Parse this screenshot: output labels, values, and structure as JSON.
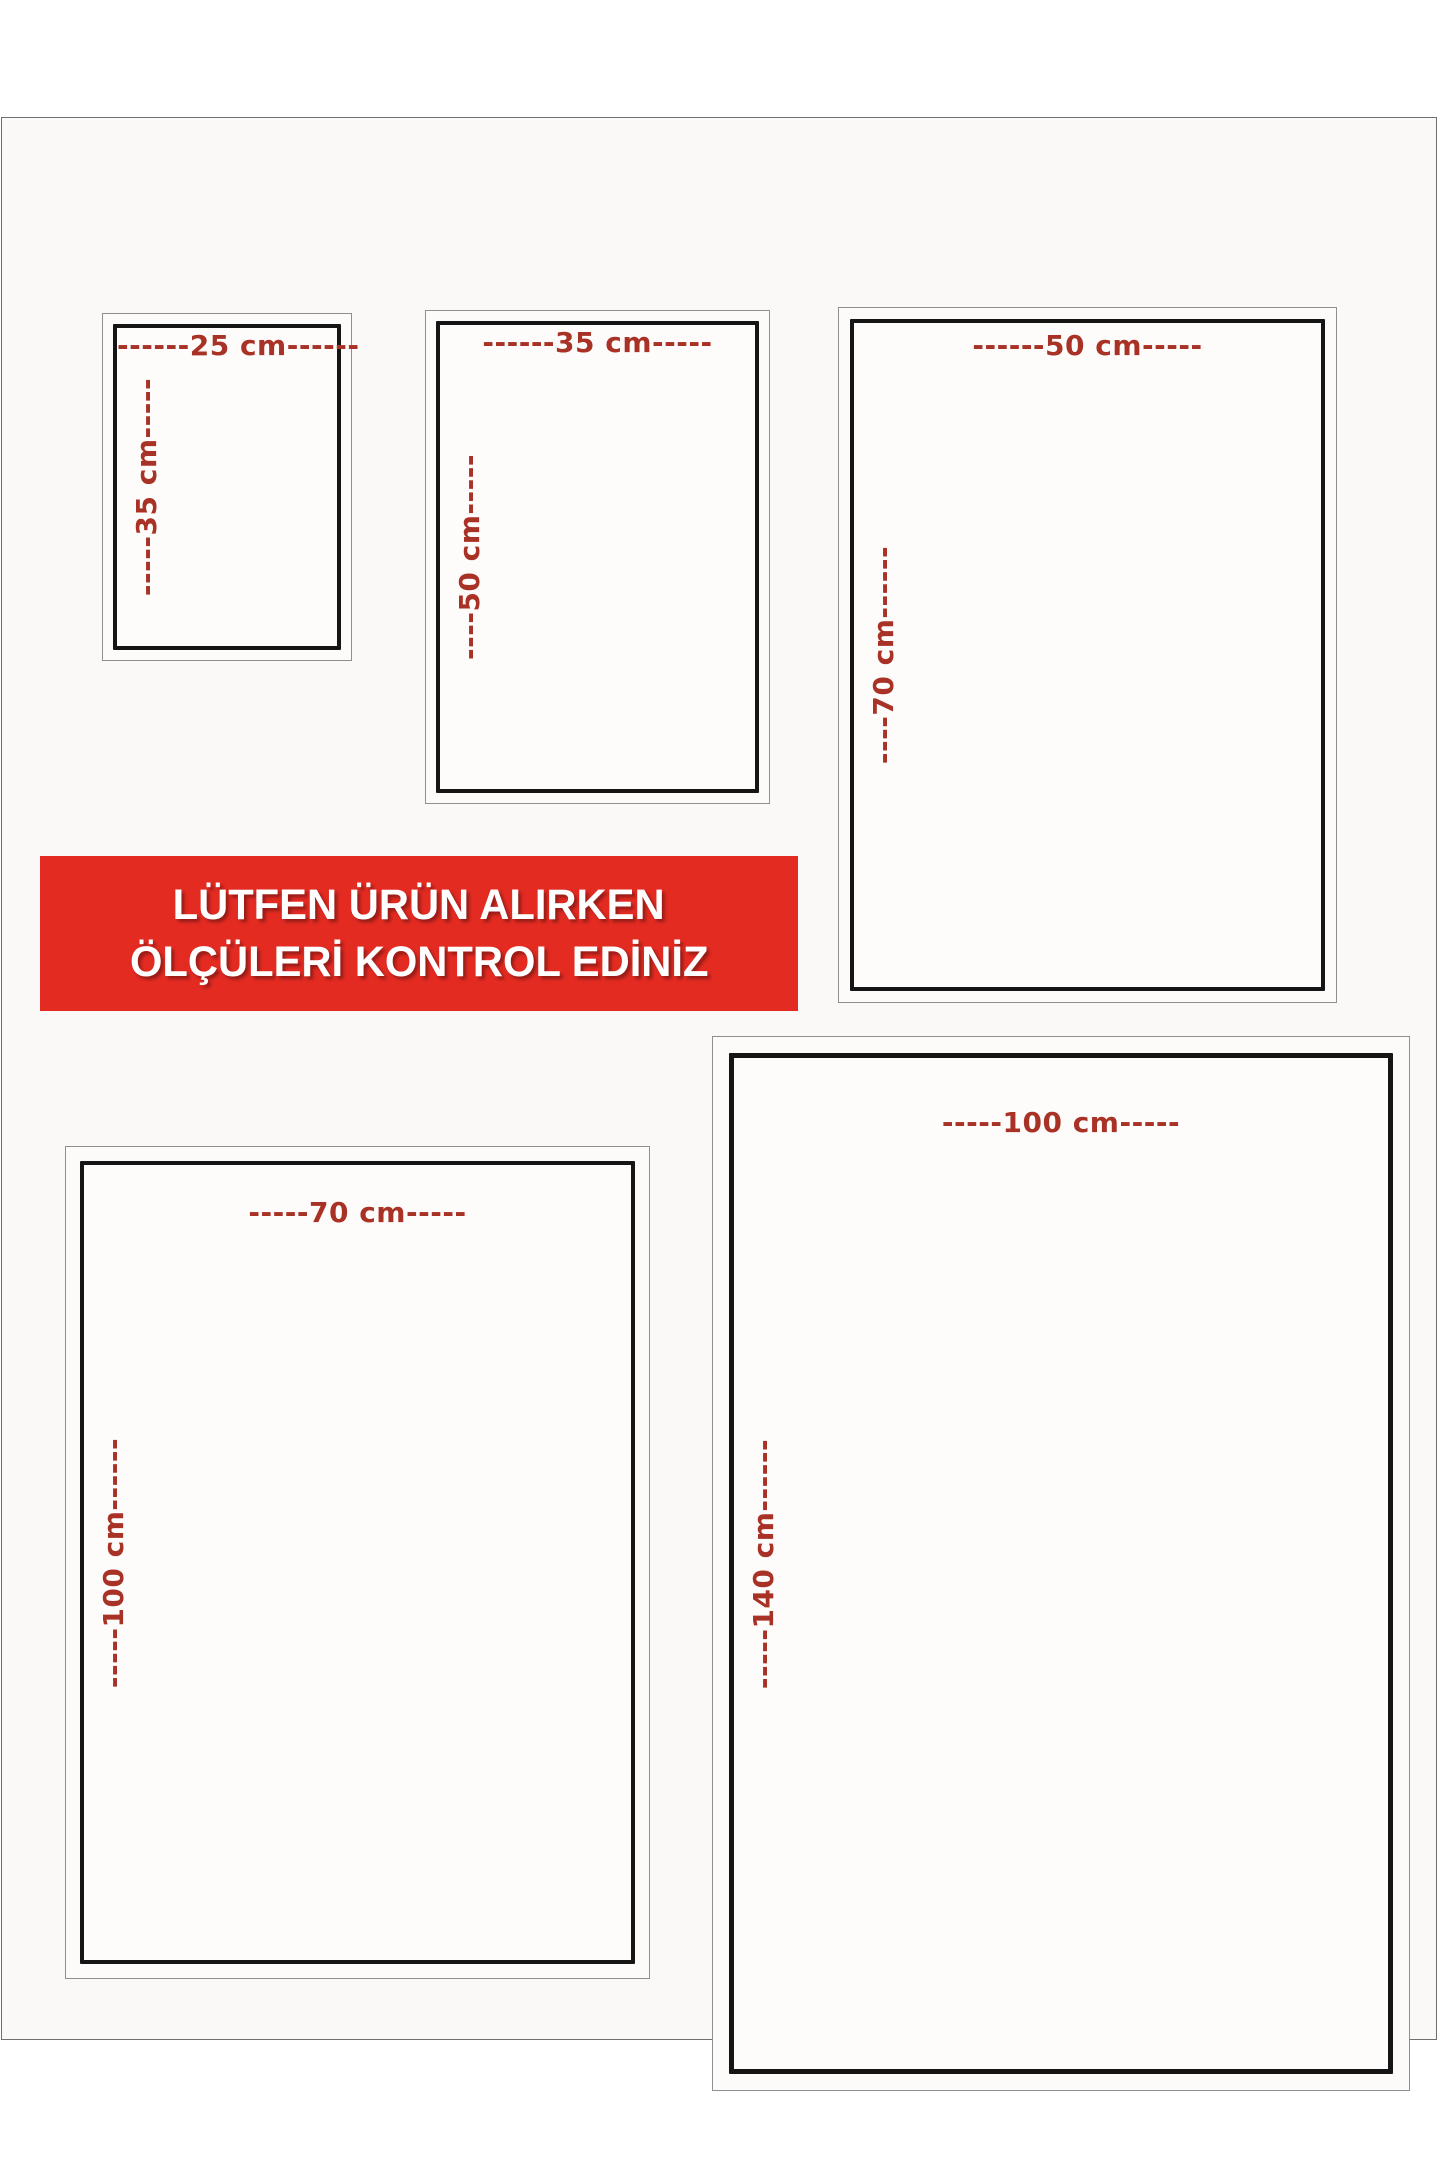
{
  "banner": {
    "line1": "LÜTFEN ÜRÜN ALIRKEN",
    "line2": "ÖLÇÜLERİ KONTROL EDİNİZ",
    "background": "#e32b22",
    "text_color": "#ffffff"
  },
  "label_color": "#a93226",
  "rectangles": [
    {
      "name": "size-25x35",
      "width_label": "------25 cm------",
      "height_label": "-----35 cm-----"
    },
    {
      "name": "size-35x50",
      "width_label": "------35 cm-----",
      "height_label": "----50 cm-----"
    },
    {
      "name": "size-50x70",
      "width_label": "------50 cm-----",
      "height_label": "----70 cm------"
    },
    {
      "name": "size-70x100",
      "width_label": "-----70 cm-----",
      "height_label": "-----100 cm------"
    },
    {
      "name": "size-100x140",
      "width_label": "-----100 cm-----",
      "height_label": "-----140 cm------"
    }
  ]
}
